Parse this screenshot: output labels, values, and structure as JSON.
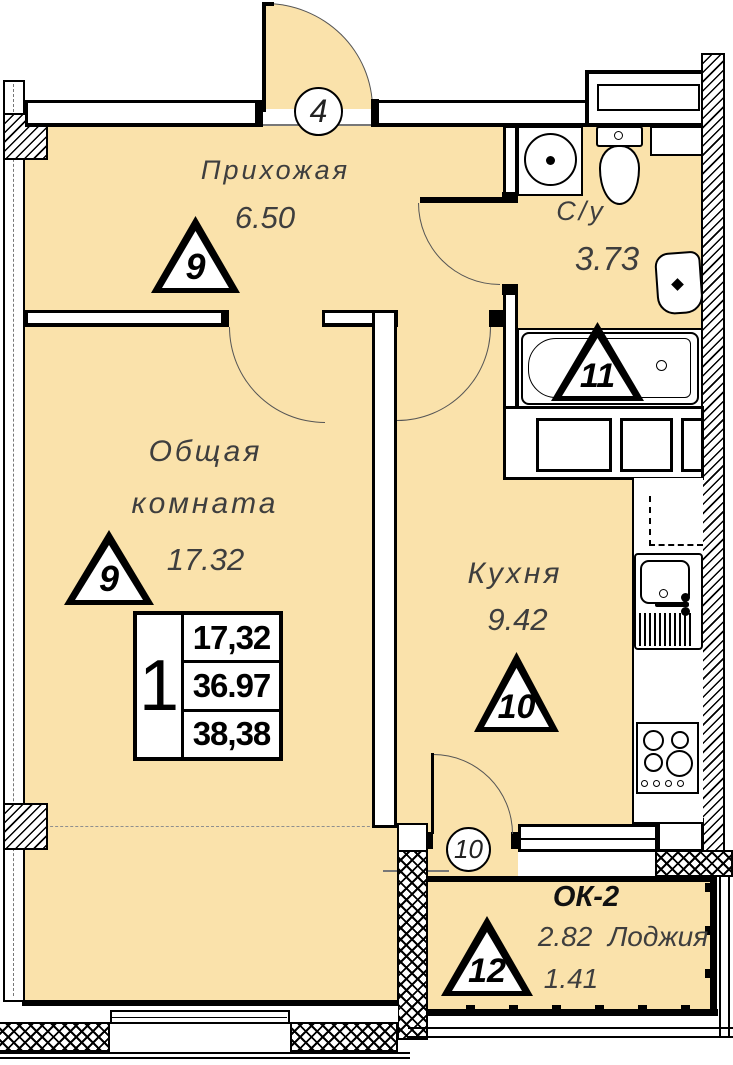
{
  "rooms": {
    "hallway": {
      "name": "Прихожая",
      "area": "6.50"
    },
    "bathroom": {
      "name": "С/у",
      "area": "3.73"
    },
    "living_room": {
      "name_line1": "Общая",
      "name_line2": "комната",
      "area": "17.32"
    },
    "kitchen": {
      "name": "Кухня",
      "area": "9.42"
    },
    "loggia": {
      "code": "ОК-2",
      "area_full": "2.82",
      "name": "Лоджия",
      "area_counted": "1.41"
    }
  },
  "markers": {
    "axis_top": "4",
    "axis_bottom": "10",
    "triangle_hallway": "9",
    "triangle_living": "9",
    "triangle_bathroom": "11",
    "triangle_kitchen": "10",
    "triangle_loggia": "12"
  },
  "apartment_table": {
    "rooms_count": "1",
    "rows": [
      "17,32",
      "36.97",
      "38,38"
    ]
  },
  "colors": {
    "floor_fill": "#fae2ab",
    "line": "#000000"
  }
}
